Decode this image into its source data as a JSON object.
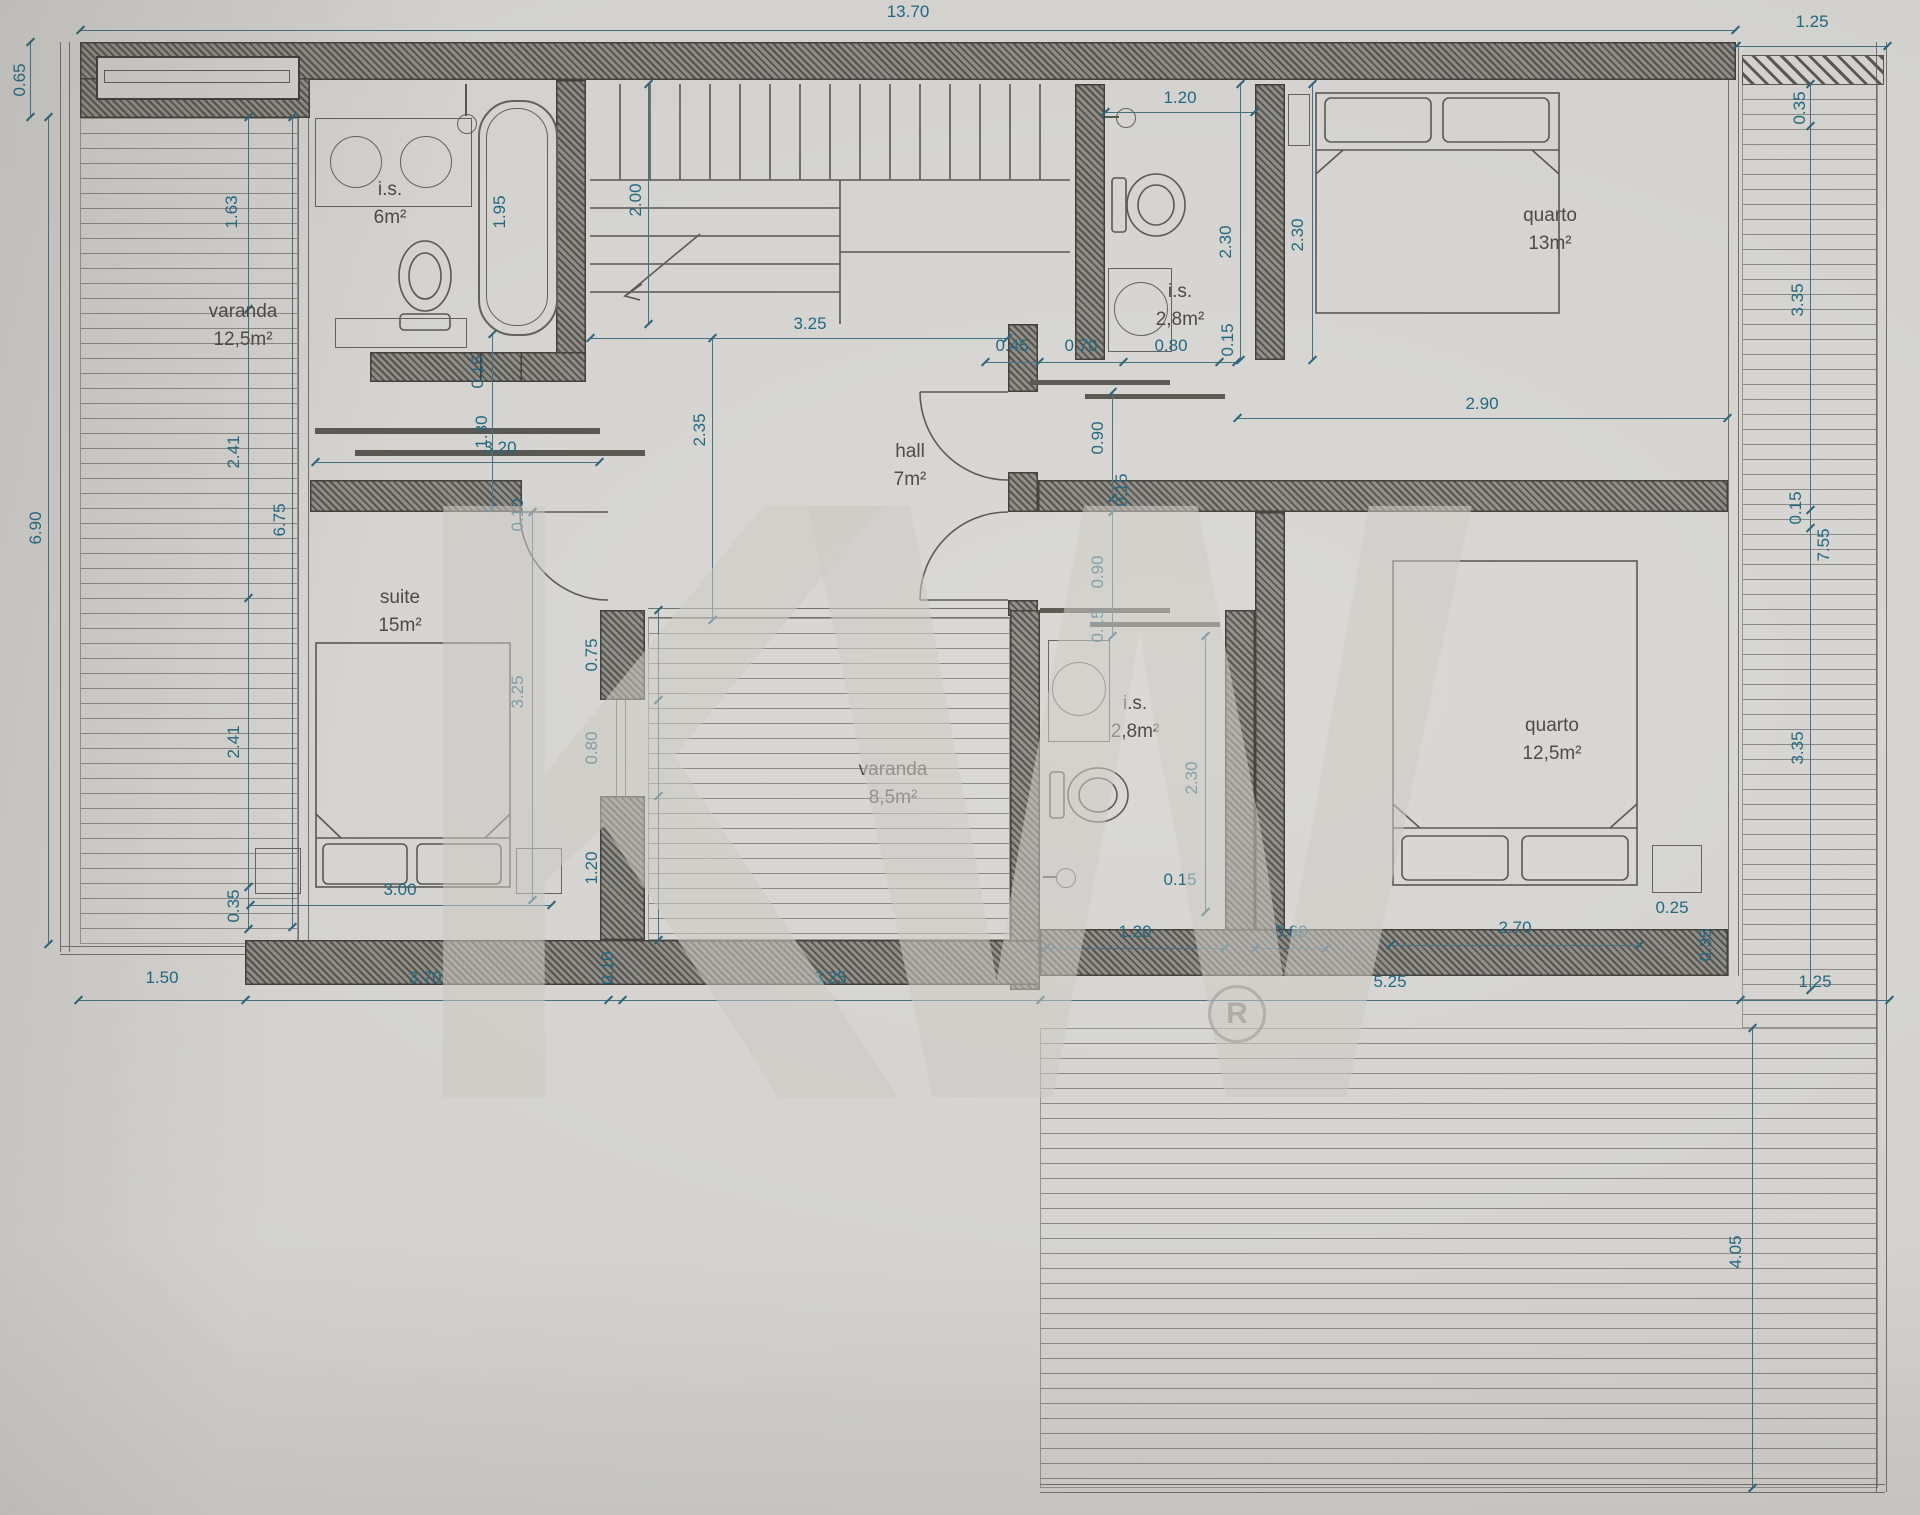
{
  "colors": {
    "paper": "#d8d7d3",
    "dimension_text": "#19647e",
    "room_text": "#454440",
    "wall": "#504e49"
  },
  "watermark": {
    "text": "KW",
    "registered": "R"
  },
  "rooms": [
    {
      "name": "varanda",
      "area": "12,5m²"
    },
    {
      "name": "i.s.",
      "area": "6m²"
    },
    {
      "name": "suite",
      "area": "15m²"
    },
    {
      "name": "hall",
      "area": "7m²"
    },
    {
      "name": "i.s.",
      "area": "2,8m²"
    },
    {
      "name": "quarto",
      "area": "13m²"
    },
    {
      "name": "varanda",
      "area": "8,5m²"
    },
    {
      "name": "i.s.",
      "area": "2,8m²"
    },
    {
      "name": "quarto",
      "area": "12,5m²"
    }
  ],
  "dims": [
    "13.70",
    "1.25",
    "0.65",
    "6.90",
    "1.63",
    "2.41",
    "2.41",
    "0.35",
    "1.95",
    "2.00",
    "3.25",
    "1.20",
    "2.30",
    "2.30",
    "0.45",
    "0.70",
    "0.80",
    "0.15",
    "2.90",
    "0.15",
    "1.30",
    "3.20",
    "2.35",
    "0.10",
    "0.90",
    "0.15",
    "0.90",
    "0.15",
    "6.75",
    "3.25",
    "3.00",
    "0.75",
    "0.80",
    "1.20",
    "2.30",
    "0.15",
    "1.20",
    "0.60",
    "2.70",
    "0.25",
    "0.35",
    "1.50",
    "3.70",
    "0.10",
    "3.25",
    "5.25",
    "1.25",
    "0.35",
    "3.35",
    "0.15",
    "7.55",
    "3.35",
    "4.05"
  ]
}
